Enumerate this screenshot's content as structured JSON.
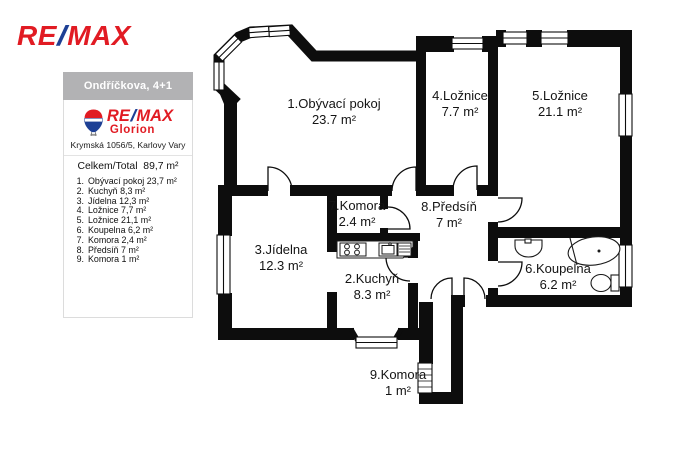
{
  "brand": {
    "wordmark": {
      "re": "RE",
      "slash": "/",
      "max": "MAX"
    },
    "office": "Glorion",
    "balloon_text": "RE/MAX"
  },
  "colors": {
    "remax_red": "#E11B23",
    "remax_blue": "#1E4095",
    "wall_black": "#0d0d0d",
    "header_gray": "#b2b2b4"
  },
  "sidebar": {
    "title": "Ondříčkova, 4+1",
    "address": "Krymská 1056/5, Karlovy Vary",
    "total_label": "Celkem/Total",
    "total_value": "89,7 m²",
    "items": [
      {
        "n": "1.",
        "t": "Obývací pokoj 23,7 m²"
      },
      {
        "n": "2.",
        "t": "Kuchyň 8,3 m²"
      },
      {
        "n": "3.",
        "t": "Jídelna 12,3 m²"
      },
      {
        "n": "4.",
        "t": "Ložnice 7,7 m²"
      },
      {
        "n": "5.",
        "t": "Ložnice 21,1 m²"
      },
      {
        "n": "6.",
        "t": "Koupelna 6,2 m²"
      },
      {
        "n": "7.",
        "t": "Komora 2,4 m²"
      },
      {
        "n": "8.",
        "t": "Předsíň 7 m²"
      },
      {
        "n": "9.",
        "t": "Komora 1 m²"
      }
    ]
  },
  "plan": {
    "rooms": [
      {
        "label": "1.Obývací pokoj",
        "area": "23.7 m²"
      },
      {
        "label": "2.Kuchyň",
        "area": "8.3 m²"
      },
      {
        "label": "3.Jídelna",
        "area": "12.3 m²"
      },
      {
        "label": "4.Ložnice",
        "area": "7.7 m²"
      },
      {
        "label": "5.Ložnice",
        "area": "21.1 m²"
      },
      {
        "label": "6.Koupelna",
        "area": "6.2 m²"
      },
      {
        "label": "7.Komora",
        "area": "2.4 m²"
      },
      {
        "label": "8.Předsíň",
        "area": "7 m²"
      },
      {
        "label": "9.Komora",
        "area": "1 m²"
      }
    ]
  }
}
